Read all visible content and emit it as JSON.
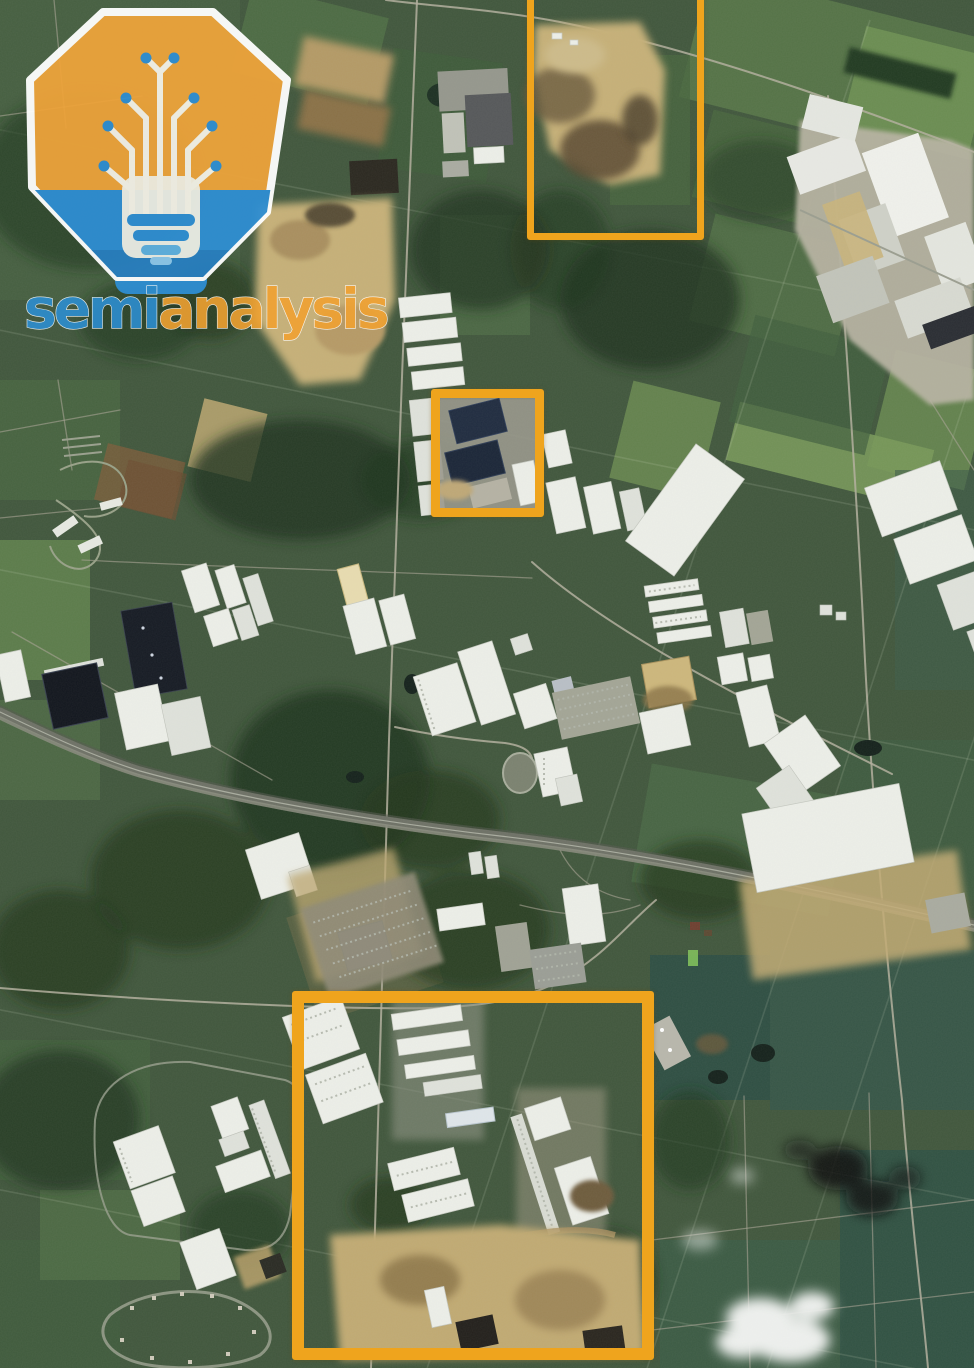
{
  "meta": {
    "kind": "annotated satellite image",
    "image_width_px": 974,
    "image_height_px": 1368,
    "view": "aerial view of semi-rural industrial and logistics corridor"
  },
  "watermark": {
    "brand_part1": "semi",
    "brand_part2": "analysis",
    "part1_color": "#2e8fd0",
    "part2_color": "#f0a232",
    "logo": {
      "shape": "heptagon-badge",
      "fill": "#eda33b",
      "base_fill": "#2f8ed3",
      "circuit_color": "#f5f2e8",
      "outline_color": "#ffffff",
      "motif": "circuit-tree-lightbulb"
    }
  },
  "annotations": {
    "color": "#efa41d",
    "boxes": [
      {
        "id": "north-site",
        "x": 527,
        "y": -16,
        "width": 177,
        "height": 256,
        "stroke": 7
      },
      {
        "id": "center-site",
        "x": 431,
        "y": 389,
        "width": 113,
        "height": 128,
        "stroke": 9
      },
      {
        "id": "south-site",
        "x": 292,
        "y": 991,
        "width": 362,
        "height": 369,
        "stroke": 12
      }
    ]
  },
  "scene": {
    "description": "Satellite photo of farmland and woodland crossed by a highway, with warehouse parks, construction sites, ponds, clouds and dark smoke plumes; three areas are outlined in orange.",
    "features": [
      "industrial-complex-northeast",
      "construction-site-north",
      "construction-site-west",
      "logistics-park-center",
      "solar-roof-buildings-center",
      "mega-warehouse-diagonal",
      "dark-roof-warehouses",
      "highway",
      "trailer-yard",
      "distribution-cluster-southwest",
      "industrial-campus-south",
      "construction-site-south",
      "residential-loop",
      "farm-fields",
      "woodland",
      "ponds",
      "clouds",
      "smoke-plumes"
    ]
  }
}
